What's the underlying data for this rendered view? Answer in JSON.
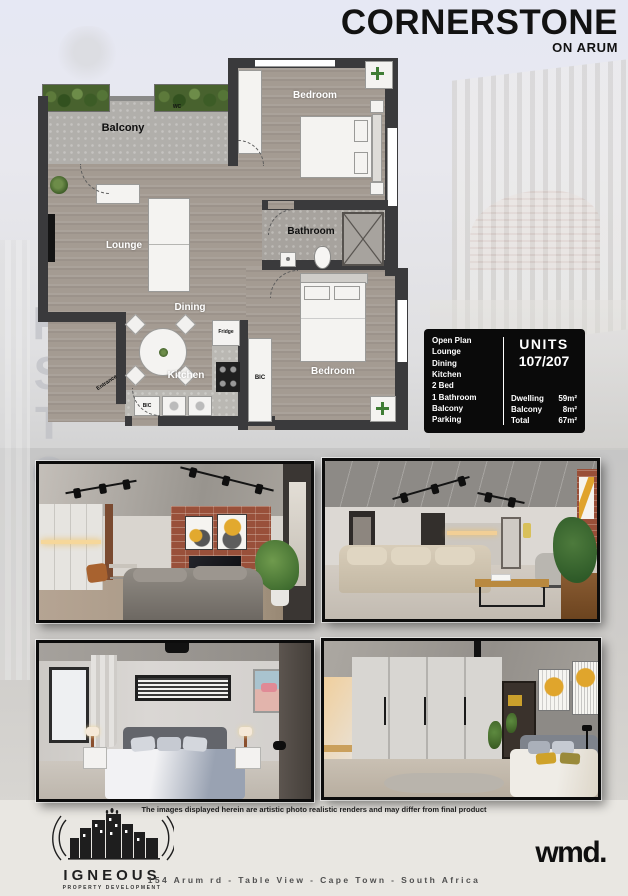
{
  "header": {
    "title": "CORNERSTONE",
    "subtitle": "ON ARUM"
  },
  "watermark": {
    "letters": [
      "R",
      "S",
      "T",
      "O",
      "N"
    ]
  },
  "floorplan": {
    "rooms": {
      "balcony": "Balcony",
      "bedroom_main": "Bedroom",
      "bedroom_second": "Bedroom",
      "lounge": "Lounge",
      "bathroom": "Bathroom",
      "dining": "Dining",
      "kitchen": "Kitchen"
    },
    "fixtures": {
      "fridge": "Fridge",
      "bic": "BIC",
      "entrance": "Entrance",
      "wc": "WC"
    }
  },
  "info_box": {
    "features": [
      "Open Plan",
      "Lounge",
      "Dining",
      "Kitchen",
      "2 Bed",
      "1 Bathroom",
      "Balcony",
      "Parking"
    ],
    "units_label": "UNITS",
    "units_value": "107/207",
    "areas": [
      {
        "label": "Dwelling",
        "value": "59m²"
      },
      {
        "label": "Balcony",
        "value": "8m²"
      },
      {
        "label": "Total",
        "value": "67m²"
      }
    ]
  },
  "photos": {
    "disclaimer": "The images displayed herein are artistic photo realistic renders and may differ from final product"
  },
  "footer": {
    "developer_name": "IGNEOUS",
    "developer_tagline": "PROPERTY DEVELOPMENT",
    "agency_logo": "wmd.",
    "address": "154 Arum rd - Table View - Cape Town - South Africa"
  },
  "colors": {
    "wall": "#3a3a3c",
    "wood_floor": "#a49b92",
    "concrete": "#b1afab",
    "info_box_bg": "#0a0a0a",
    "brick_accent": "#99503a",
    "plant_green": "#48622e"
  }
}
